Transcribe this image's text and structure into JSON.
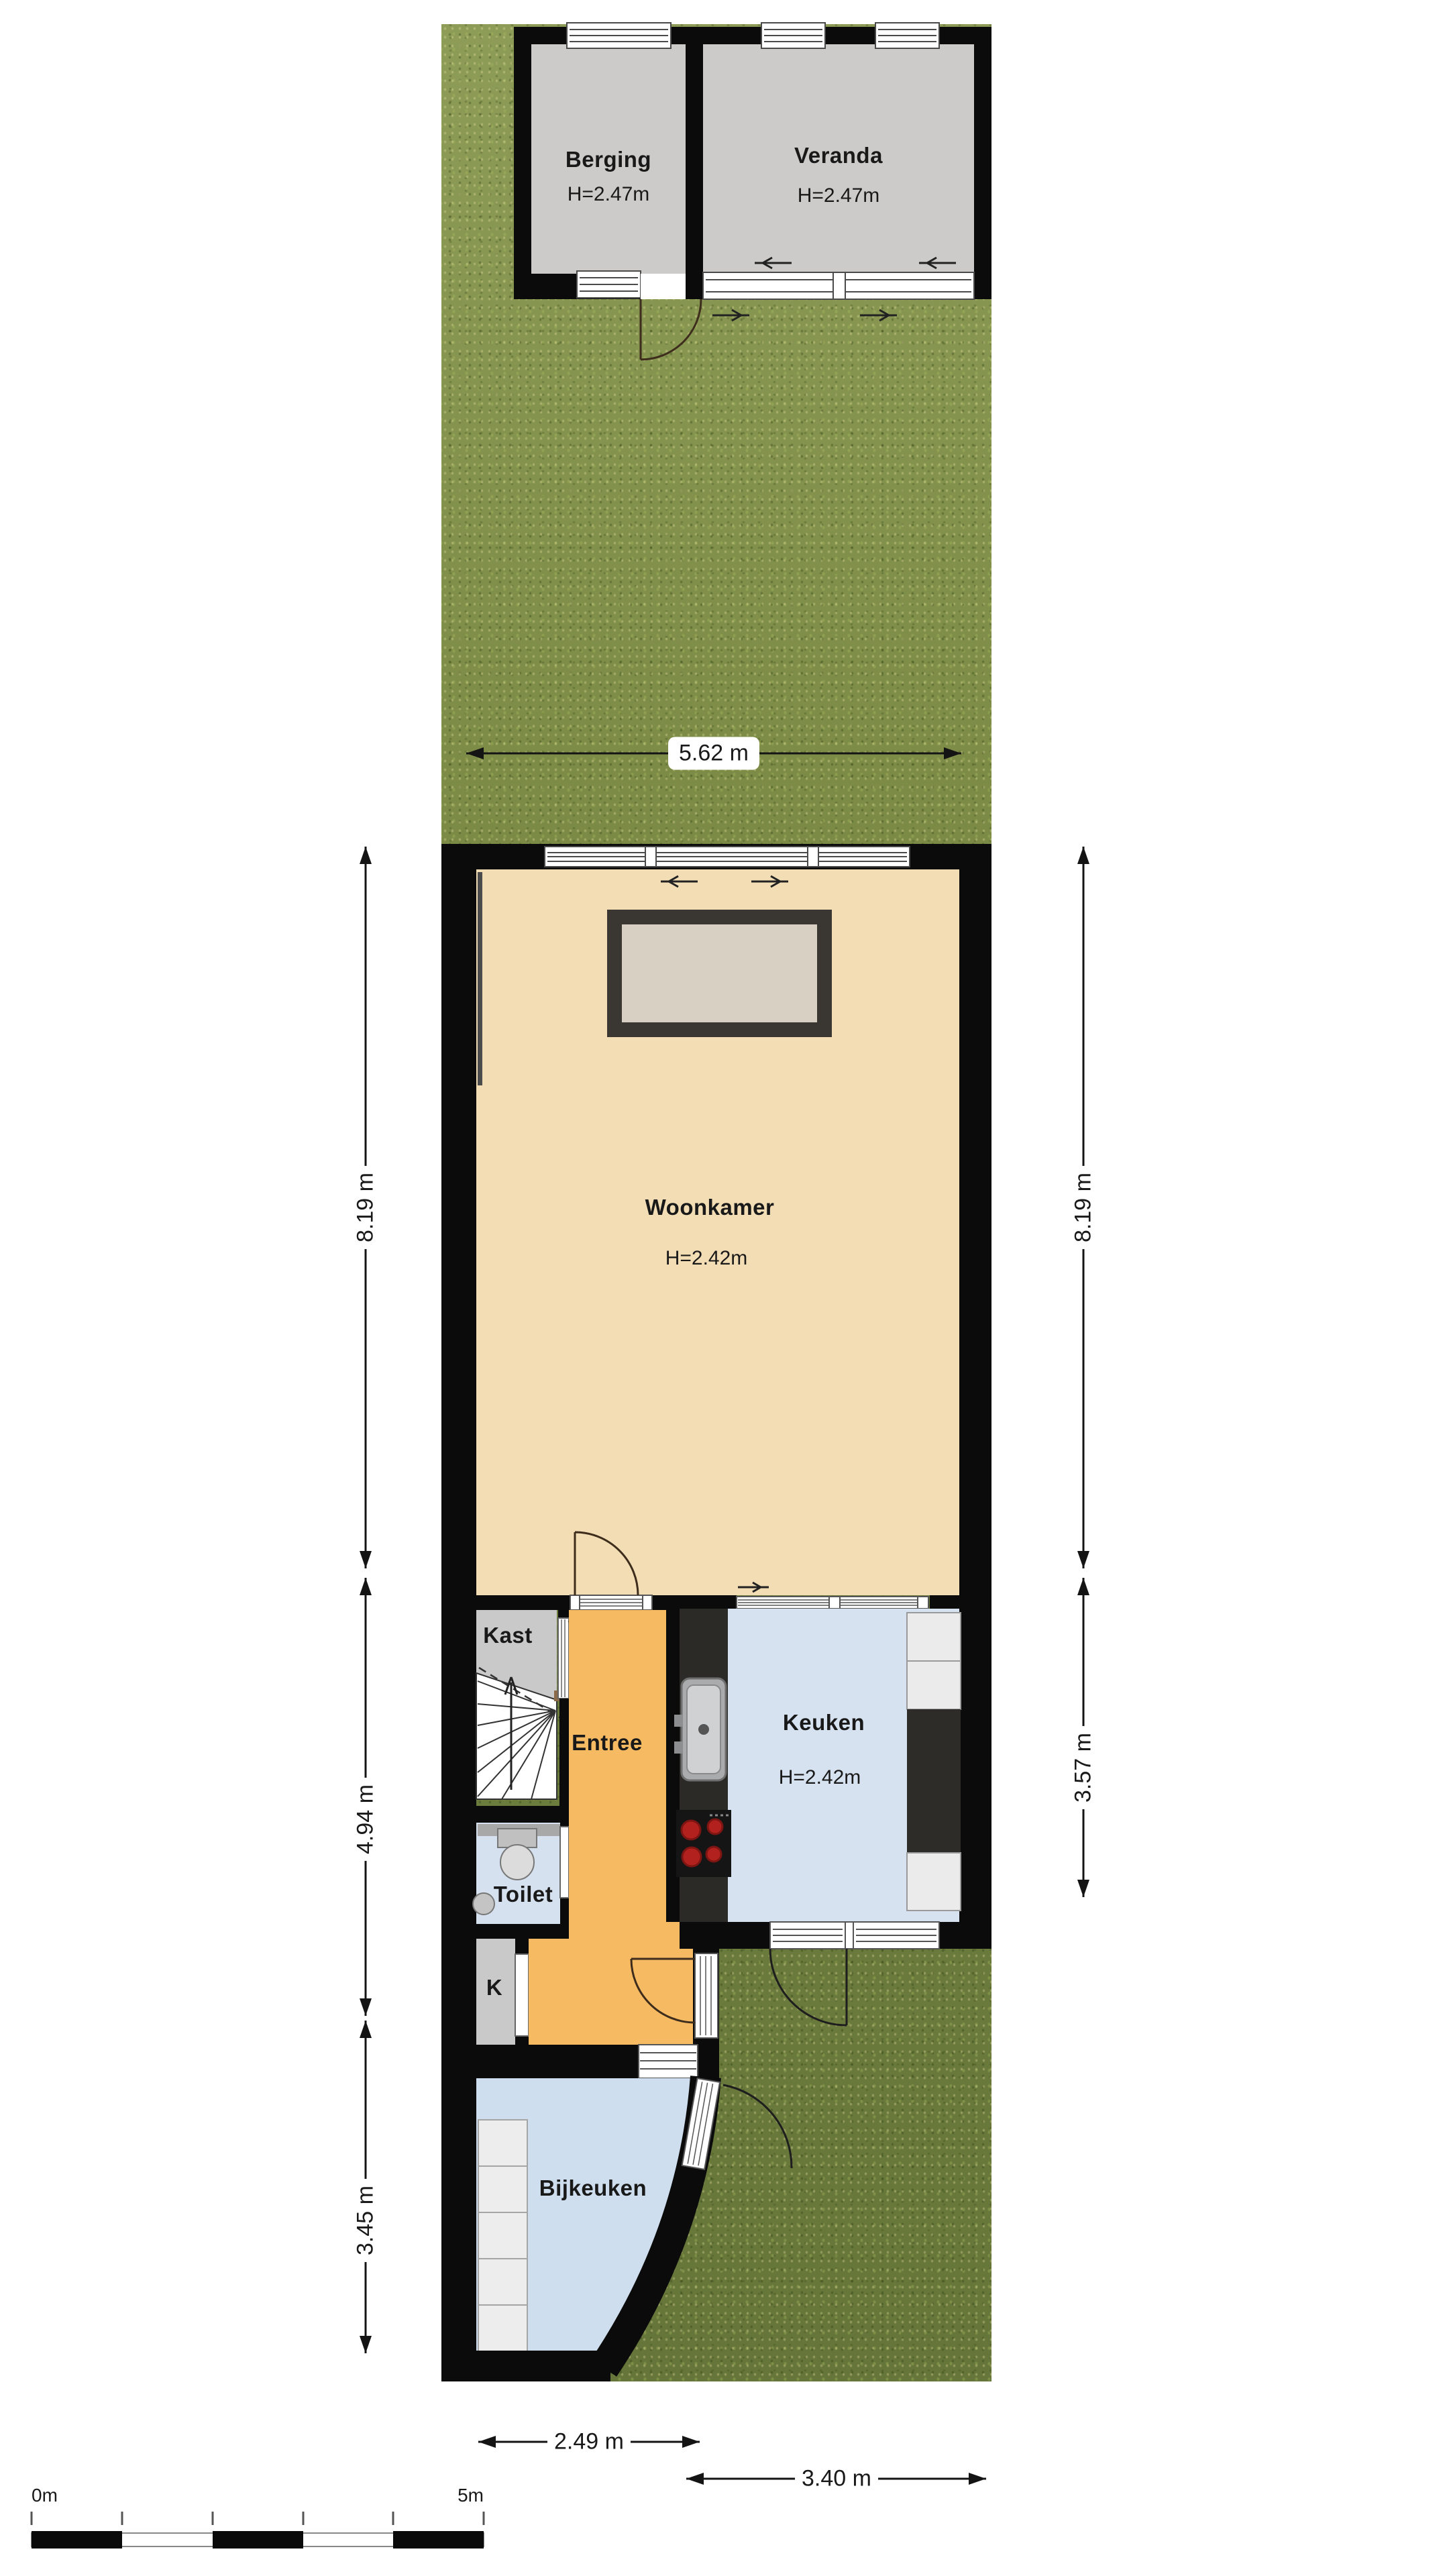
{
  "plan": {
    "title": "Begane grond plattegrond",
    "rooms": {
      "berging": {
        "name": "Berging",
        "height": "H=2.47m"
      },
      "veranda": {
        "name": "Veranda",
        "height": "H=2.47m"
      },
      "woonkamer": {
        "name": "Woonkamer",
        "height": "H=2.42m"
      },
      "kast": {
        "name": "Kast"
      },
      "entree": {
        "name": "Entree"
      },
      "keuken": {
        "name": "Keuken",
        "height": "H=2.42m"
      },
      "toilet": {
        "name": "Toilet"
      },
      "k": {
        "name": "K"
      },
      "bijkeuken": {
        "name": "Bijkeuken"
      }
    },
    "dimensions": {
      "garden_width": "5.62 m",
      "living_depth_left": "8.19 m",
      "living_depth_right": "8.19 m",
      "hall_depth": "4.94 m",
      "kitchen_depth": "3.57 m",
      "utility_depth": "3.45 m",
      "utility_width": "2.49 m",
      "kitchen_width": "3.40 m"
    },
    "scale_bar": {
      "start": "0m",
      "end": "5m"
    },
    "colors": {
      "grass": "#76853f",
      "wall": "#0b0b0b",
      "living_floor": "#f2ddb5",
      "hall_floor": "#f6bb62",
      "kitchen_floor": "#d6e2f0",
      "utility_floor": "#cfdeee",
      "closet_floor": "#c9c9c9",
      "shed_floor": "#cccbca",
      "counter": "#2b2a27",
      "burner_red": "#b3211f"
    }
  }
}
